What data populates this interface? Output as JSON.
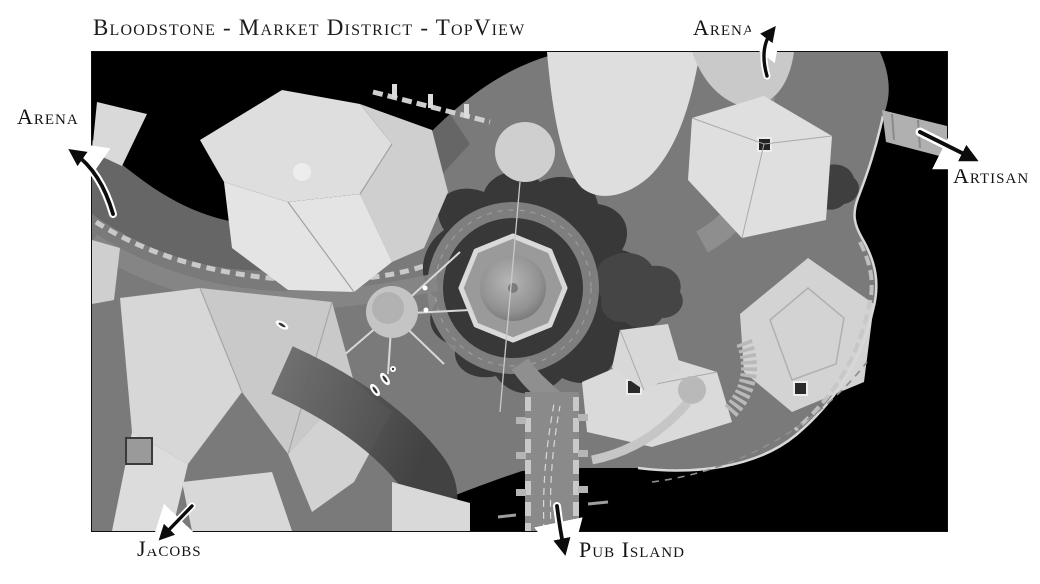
{
  "title": {
    "text": "Bloodstone - Market District - TopView"
  },
  "labels": [
    {
      "id": "arena-west",
      "text": "Arena"
    },
    {
      "id": "arena-north",
      "text": "Arena"
    },
    {
      "id": "artisan",
      "text": "Artisan"
    },
    {
      "id": "jacobs",
      "text": "Jacobs"
    },
    {
      "id": "pub-island",
      "text": "Pub Island"
    }
  ],
  "map": {
    "description": "Grayscale top-down 3D render of the Bloodstone Market District",
    "colors": {
      "page_background": "#ffffff",
      "map_background": "#000000",
      "terrain": "#7a7a7a",
      "terrain_shade": "#5e5e5e",
      "roof_light": "#dedede",
      "roof_mid": "#c9c9c9",
      "rock_dark": "#3a3a3a",
      "road": "#8d8d8d",
      "wall": "#cccccc",
      "label_text": "#141414"
    }
  }
}
